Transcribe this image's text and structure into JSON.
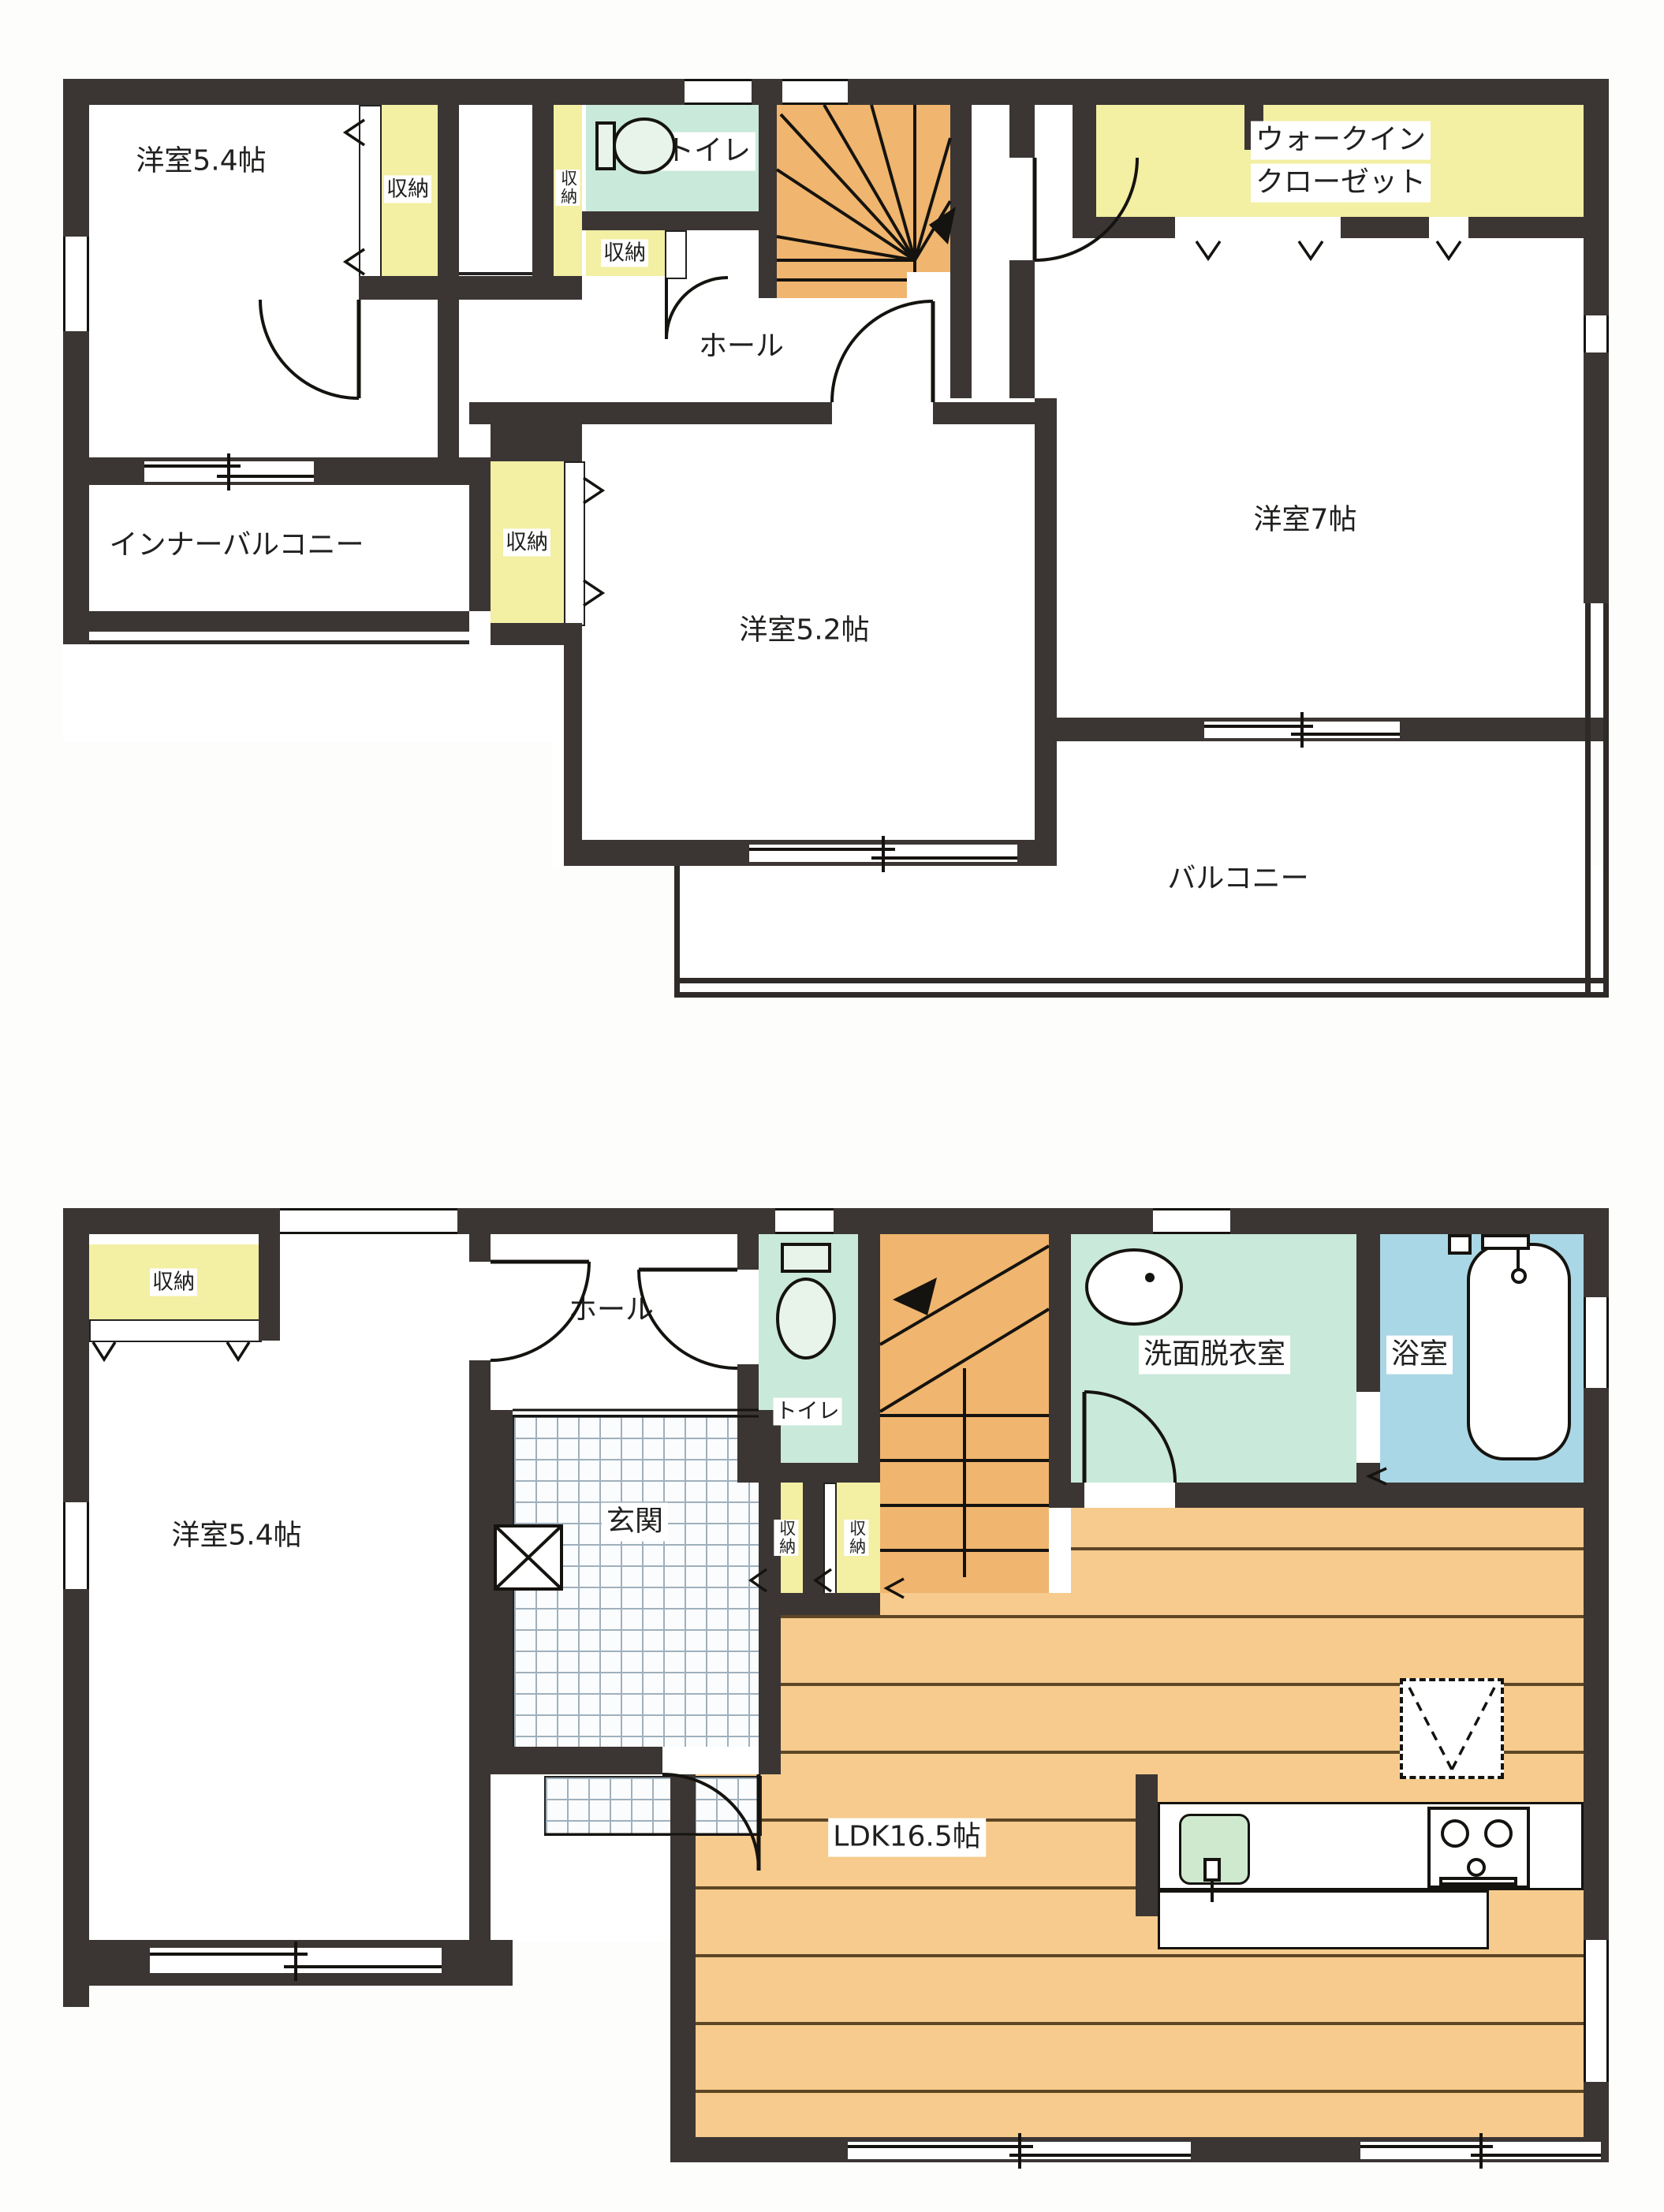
{
  "colors": {
    "wall": "#3b3633",
    "closet_yellow": "#f3efa3",
    "sanitary_teal": "#c9e9da",
    "bath_blue": "#aad7e5",
    "stairs_orange": "#f0b56e",
    "wood_floor": "#f6cb8d"
  },
  "upper": {
    "bedroom_54": "洋室5.4帖",
    "closet_a": "収納",
    "closet_b": "収納",
    "toilet": "トイレ",
    "closet_c": "収納",
    "wic_line1": "ウォークイン",
    "wic_line2": "クローゼット",
    "hall": "ホール",
    "closet_d": "収納",
    "bedroom_52": "洋室5.2帖",
    "bedroom_7": "洋室7帖",
    "inner_balcony": "インナーバルコニー",
    "balcony": "バルコニー"
  },
  "lower": {
    "closet_f": "収納",
    "hall": "ホール",
    "toilet": "トイレ",
    "genkan": "玄関",
    "closet_g": "収納",
    "closet_h": "収納",
    "washroom": "洗面脱衣室",
    "bath": "浴室",
    "bedroom_54": "洋室5.4帖",
    "ldk": "LDK16.5帖"
  }
}
